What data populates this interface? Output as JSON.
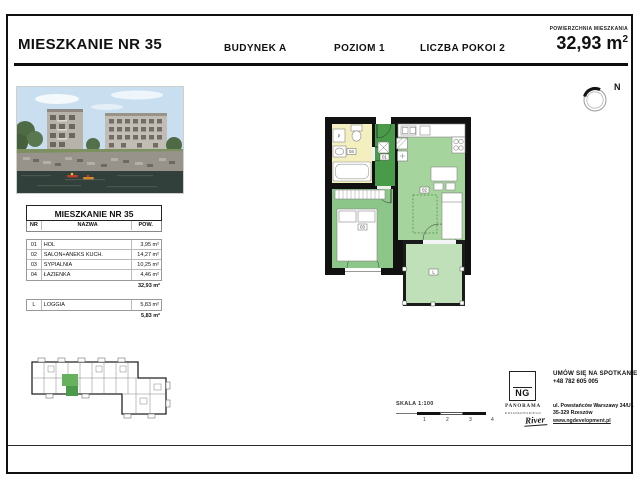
{
  "header": {
    "title": "MIESZKANIE NR 35",
    "budynek": "BUDYNEK  A",
    "poziom": "POZIOM  1",
    "liczba_pokoi": "LICZBA POKOI  2",
    "area_label": "POWIERZCHNIA MIESZKANIA",
    "area_value": "32,93 m",
    "area_sup": "2"
  },
  "table": {
    "title": "MIESZKANIE NR 35",
    "columns": {
      "nr": "NR",
      "nazwa": "NAZWA",
      "pow": "POW."
    },
    "rows": [
      {
        "nr": "01",
        "name": "HOL",
        "area": "3,95 m²"
      },
      {
        "nr": "02",
        "name": "SALON+ANEKS KUCH.",
        "area": "14,27 m²"
      },
      {
        "nr": "03",
        "name": "SYPIALNIA",
        "area": "10,25 m²"
      },
      {
        "nr": "04",
        "name": "ŁAZIENKA",
        "area": "4,46 m²"
      }
    ],
    "total": "32,93 m²",
    "loggia_row": {
      "nr": "L",
      "name": "LOGGIA",
      "area": "5,83 m²"
    },
    "loggia_total": "5,83 m²"
  },
  "floorplan": {
    "labels": {
      "hol": "01",
      "salon": "02",
      "sypialnia": "03",
      "lazienka": "04",
      "loggia": "L",
      "washer": "P"
    }
  },
  "compass": {
    "letter": "N"
  },
  "scale": {
    "label": "SKALA 1:100",
    "ticks": [
      "1",
      "2",
      "3",
      "4"
    ]
  },
  "logo": {
    "ng": "NG",
    "brand": "PANORAMA",
    "brand_sub": "KWIATKOWSKIEGO",
    "script": "River"
  },
  "contact": {
    "headline": "UMÓW SIĘ NA SPOTKANIE",
    "phone": "+48 782 605 005",
    "address1": "ul. Powstańców Warszawy 34/U1",
    "address2": "35-329 Rzeszów",
    "website": "www.ngdevelopment.pl"
  },
  "colors": {
    "wall": "#111111",
    "hol_green": "#4a9b49",
    "salon_green": "#a6d49d",
    "bedroom_green": "#8cc789",
    "loggia_green": "#bfe0b8",
    "bathroom_yellow": "#f3efbe"
  }
}
